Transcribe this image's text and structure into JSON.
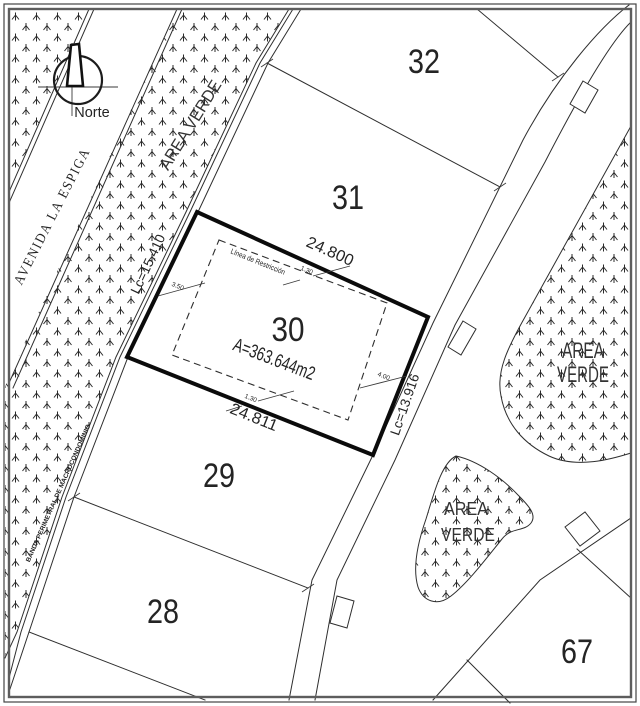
{
  "colors": {
    "paper": "#ffffff",
    "ink": "#2e2e2e",
    "lot30_outline": "#0b0b0b"
  },
  "north_arrow": {
    "label": "Norte"
  },
  "streets": {
    "avenue": "AVENIDA LA ESPIGA",
    "perimeter_band": "BANDA PERIMETRAL DE MACROCONDOMINIO"
  },
  "green_areas": {
    "strip": "AREA VERDE",
    "right": {
      "line1": "AREA",
      "line2": "VERDE"
    },
    "south": {
      "line1": "AREA",
      "line2": "VERDE"
    }
  },
  "lots": {
    "lot28": "28",
    "lot29": "29",
    "lot31": "31",
    "lot32": "32",
    "lot67": "67"
  },
  "lot30": {
    "number": "30",
    "area": "A=363.644m2",
    "restriction_line": "Línea de Restricción",
    "dim_front": "24.800",
    "dim_back": "24.811",
    "curve_left": "Lc=15.410",
    "curve_right": "Lc=13.916",
    "setback_front": "1.30",
    "setback_back": "1.30",
    "setback_left": "3.50",
    "setback_right": "4.00"
  }
}
